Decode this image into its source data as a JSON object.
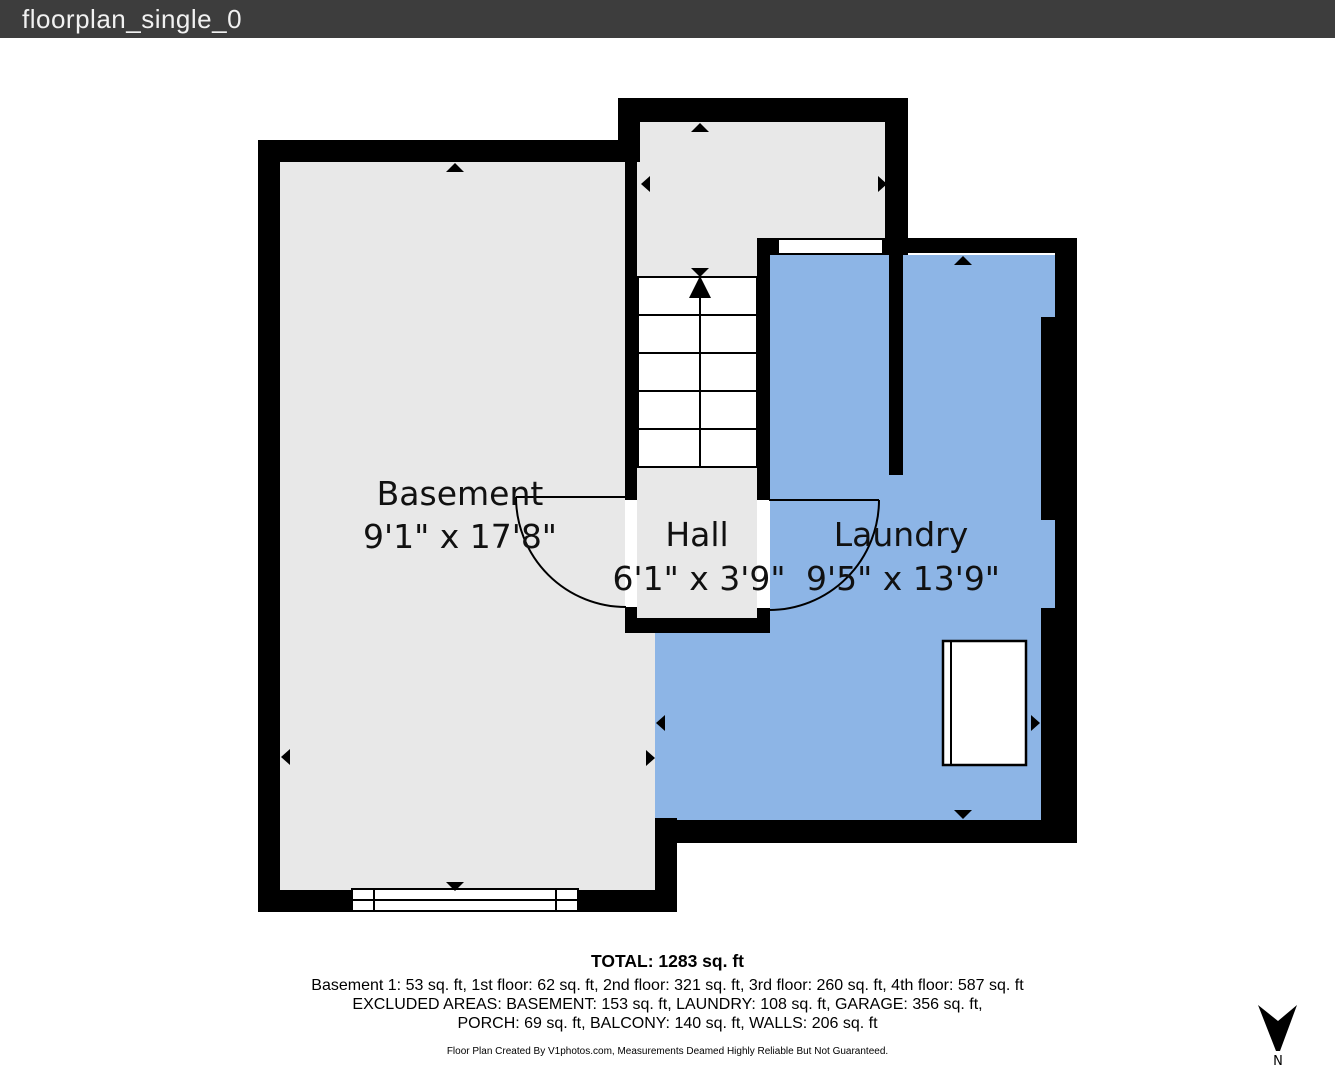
{
  "titlebar": {
    "title": "floorplan_single_0"
  },
  "rooms": {
    "basement": {
      "name": "Basement",
      "dimensions": "9'1\" x 17'8\""
    },
    "hall": {
      "name": "Hall",
      "dimensions": "6'1\" x 3'9\""
    },
    "laundry": {
      "name": "Laundry",
      "dimensions": "9'5\" x 13'9\""
    }
  },
  "summary": {
    "total": "TOTAL: 1283 sq. ft",
    "floors": "Basement 1: 53 sq. ft, 1st floor: 62 sq. ft, 2nd floor: 321 sq. ft, 3rd floor: 260 sq. ft, 4th floor: 587 sq. ft",
    "excluded_line1": "EXCLUDED AREAS: BASEMENT: 153 sq. ft, LAUNDRY: 108 sq. ft, GARAGE: 356 sq. ft,",
    "excluded_line2": "PORCH: 69 sq. ft, BALCONY: 140 sq. ft, WALLS: 206 sq. ft",
    "disclaimer": "Floor Plan Created By V1photos.com, Measurements Deamed Highly Reliable But Not Guaranteed."
  },
  "compass": {
    "label": "N"
  },
  "colors": {
    "wall": "#000000",
    "room_fill": "#e8e8e8",
    "laundry_fill": "#8db5e6",
    "titlebar_bg": "#3d3d3d",
    "titlebar_text": "#f1f1f1"
  }
}
